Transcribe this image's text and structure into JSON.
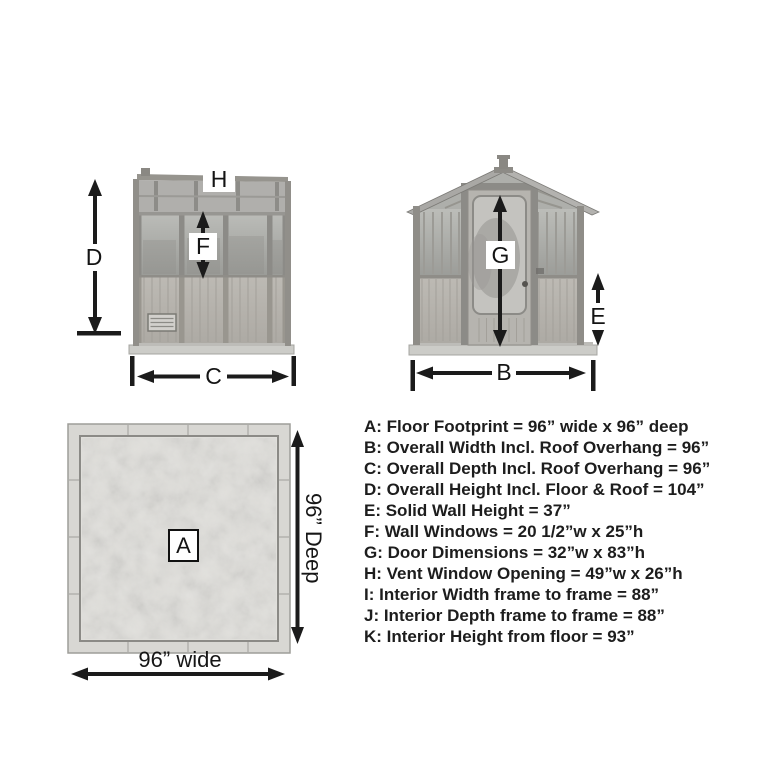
{
  "diagram": {
    "title": "Greenhouse dimension diagram",
    "callouts": {
      "overall_height": "D",
      "vent_window": "H",
      "wall_window": "F",
      "overall_depth": "C",
      "door": "G",
      "solid_wall": "E",
      "overall_width": "B",
      "floor_footprint": "A"
    },
    "floor_plan": {
      "width_text": "96” wide",
      "depth_text": "96” Deep"
    }
  },
  "legend": {
    "items": [
      "A: Floor Footprint = 96” wide x 96” deep",
      "B: Overall Width Incl. Roof Overhang = 96”",
      "C: Overall Depth Incl. Roof Overhang = 96”",
      "D: Overall Height Incl. Floor & Roof = 104”",
      "E: Solid Wall Height = 37”",
      "F: Wall Windows = 20 1/2”w x 25”h",
      "G: Door Dimensions = 32”w x 83”h",
      "H: Vent Window Opening = 49”w x 26”h",
      "I: Interior Width frame to frame = 88”",
      "J: Interior Depth frame to frame = 88”",
      "K: Interior Height from floor = 93”"
    ]
  },
  "colors": {
    "ink": "#1b1b1b",
    "background": "#ffffff",
    "structure_gray": "#a8a7a4",
    "wood_gray": "#b8b5af",
    "glass_gray": "#b3b4b0",
    "concrete_gray": "#e0dfdb"
  }
}
